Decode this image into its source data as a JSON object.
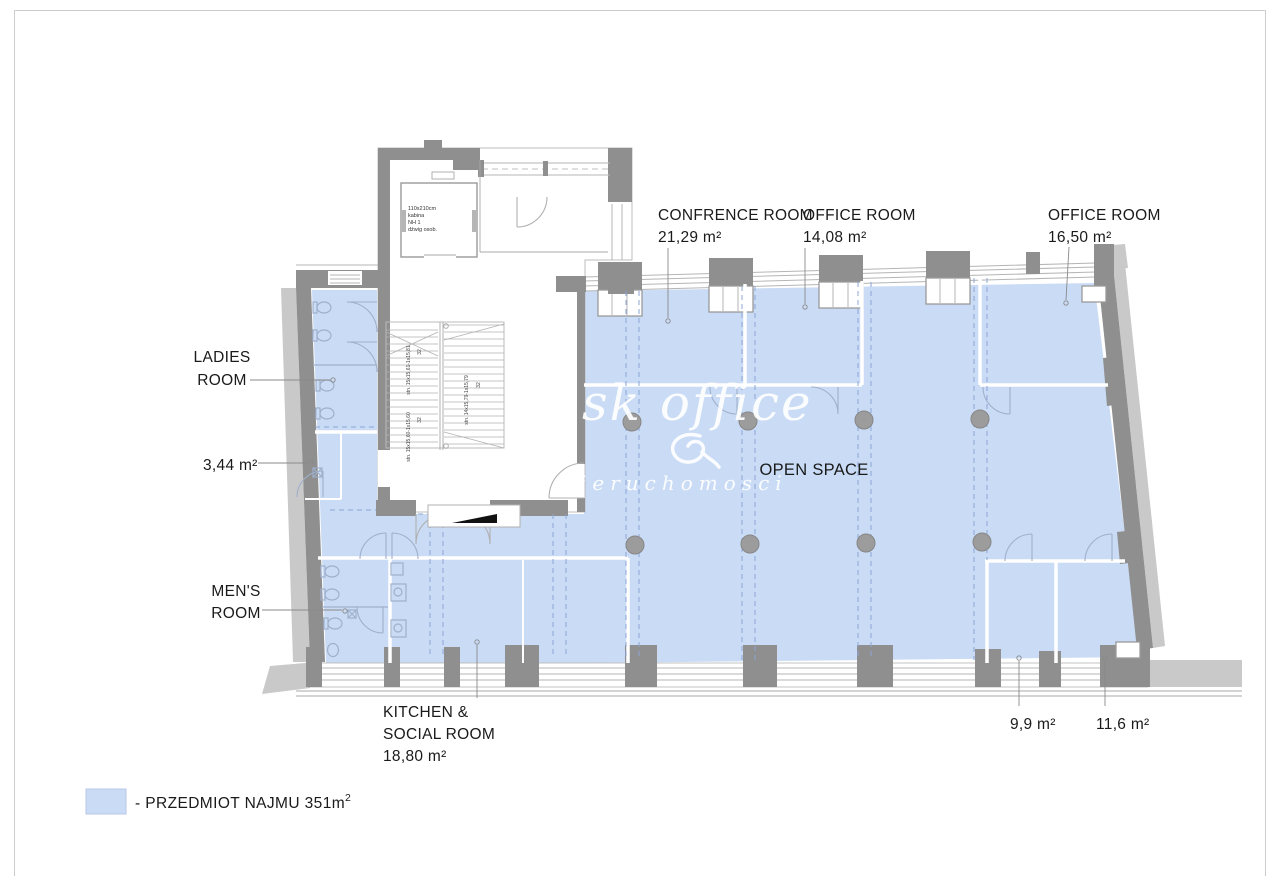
{
  "colors": {
    "rental_blue": "#c9dbf5",
    "wall_dark": "#8f8f8f",
    "wall_light": "#c9c9c9",
    "thin_line": "#b5b5b5",
    "partition_line": "#9fb0cc",
    "dash_blue": "#8ba6d3",
    "leader": "#8a8a8a",
    "text": "#1a1a1a",
    "watermark": "#ffffff",
    "page_border": "#cccccc",
    "column_fill": "#9c9c9c"
  },
  "labels": {
    "conference": {
      "name": "CONFRENCE ROOM",
      "area": "21,29 m²"
    },
    "office_14": {
      "name": "OFFICE ROOM",
      "area": "14,08 m²"
    },
    "office_16": {
      "name": "OFFICE ROOM",
      "area": "16,50 m²"
    },
    "ladies": {
      "name_line1": "LADIES",
      "name_line2": "ROOM",
      "area": "3,44 m²"
    },
    "mens": {
      "name_line1": "MEN'S",
      "name_line2": "ROOM"
    },
    "kitchen": {
      "name_line1": "KITCHEN &",
      "name_line2": "SOCIAL ROOM",
      "area": "18,80 m²"
    },
    "open_space": "OPEN SPACE",
    "room_small_1": "9,9 m²",
    "room_small_2": "11,6 m²"
  },
  "legend": {
    "text": "- PRZEDMIOT NAJMU 351m",
    "superscript": "2"
  },
  "watermark": {
    "title": "sk office",
    "subtitle": "ieruchomosci"
  },
  "elevator": {
    "line1": "110x210cm",
    "line2": "kabina",
    "line3": "NH 1",
    "line4": "dźwig osob."
  },
  "stairs": {
    "flight1_dim": "stn. 15x15,61-1x15,81",
    "flight1_count": "32",
    "flight2_dim": "stn. 15x15,60-1x15,60",
    "flight2_count": "32",
    "flight3_dim": "stn. 14x15,79-1x15,79",
    "flight3_count": "32"
  }
}
